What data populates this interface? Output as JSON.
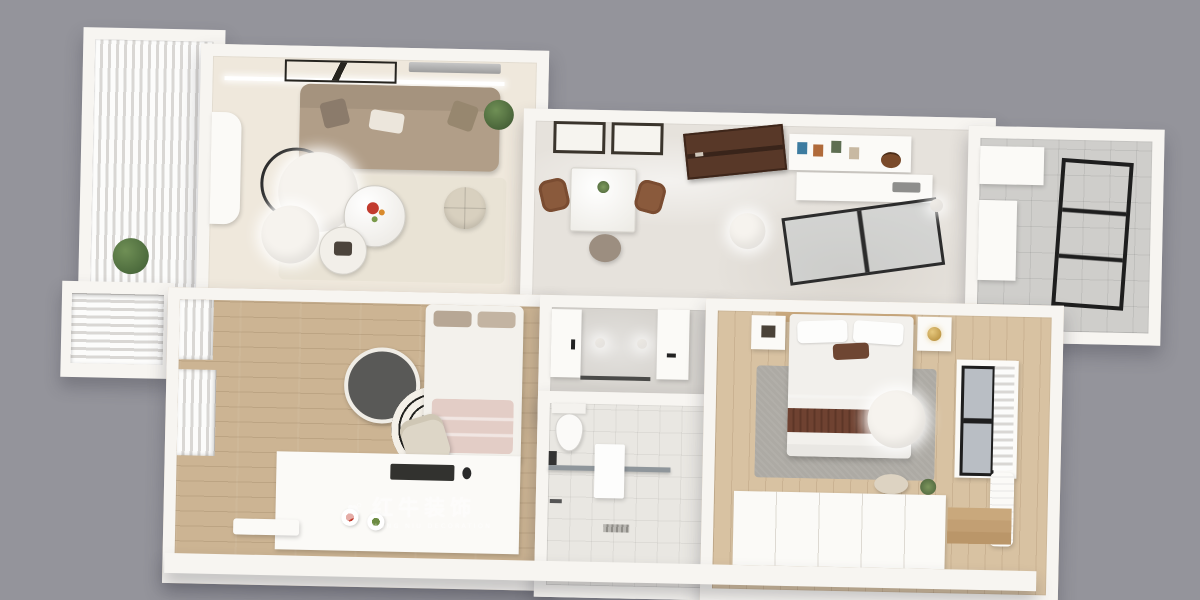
{
  "canvas": {
    "width": 1200,
    "height": 600,
    "background_color": "#94949b"
  },
  "watermark": {
    "brand_cn": "红牛装饰",
    "brand_en": "HONG NIU DECORATION",
    "logo": "bull-logo-icon",
    "color": "#ffffff"
  },
  "palette": {
    "wall": "#f7f5f1",
    "living_floor": "#efe8dc",
    "hall_marble_floor": "#e6e2dc",
    "bedroom_small_wood": "#ccb493",
    "master_bedroom_wood": "#d8c2a2",
    "bath_tile": "#e9e7e2",
    "utility_gray_tile": "#cfcecb",
    "sofa_tan": "#b19e88",
    "living_rug": "#e9e3d5",
    "entry_door_brown": "#583828",
    "dining_chair_brown": "#8a5a3c",
    "duvet_gray": "#b7b3b0",
    "throw_brown": "#6f4231",
    "dark_round_rug": "#595957",
    "blanket_pink": "#e3cdc6"
  },
  "rooms": [
    {
      "name": "living-balcony",
      "items": [
        "sheer-curtain",
        "plant"
      ]
    },
    {
      "name": "living-room",
      "items": [
        "tv-console",
        "sofa",
        "sofa-pillows",
        "area-rug",
        "coffee-table-large",
        "coffee-table-small",
        "arc-floor-lamp",
        "lamp-ring",
        "pouf",
        "wall-art",
        "ac-vent",
        "light-track",
        "plant"
      ]
    },
    {
      "name": "dining-hall-entry",
      "items": [
        "picture-frame",
        "picture-frame",
        "dining-table",
        "dining-chair",
        "dining-chair",
        "stool",
        "entry-door",
        "console-shelf",
        "hand-bag",
        "ceiling-lamp",
        "kitchen-counter",
        "kitchen-glass-partition",
        "pendant-light"
      ]
    },
    {
      "name": "utility-balcony",
      "items": [
        "cabinet",
        "dark-glass-door",
        "side-counter"
      ]
    },
    {
      "name": "bay-window",
      "items": [
        "roller-shade"
      ]
    },
    {
      "name": "bedroom-small",
      "items": [
        "window-shade",
        "window-shade",
        "single-bed",
        "pink-blanket",
        "dark-round-rug",
        "striped-round-rug",
        "desk-chair",
        "tatami-platform",
        "keyboard",
        "mouse",
        "snack-plates",
        "tray"
      ]
    },
    {
      "name": "bathroom-vanity",
      "items": [
        "door-panel",
        "vanity",
        "faucet",
        "downlight",
        "downlight"
      ]
    },
    {
      "name": "bathroom-wet",
      "items": [
        "toilet",
        "paper-holder",
        "shower-glass",
        "towel",
        "shower-head",
        "floor-drain"
      ]
    },
    {
      "name": "master-bedroom",
      "items": [
        "headboard",
        "nightstand",
        "nightstand",
        "gold-table-lamp",
        "double-bed",
        "accent-pillow",
        "gray-duvet",
        "brown-throw",
        "gray-rug",
        "ceiling-lamp",
        "window",
        "curtain",
        "ac-unit",
        "stool",
        "wardrobe",
        "wood-steps",
        "plant"
      ]
    }
  ]
}
